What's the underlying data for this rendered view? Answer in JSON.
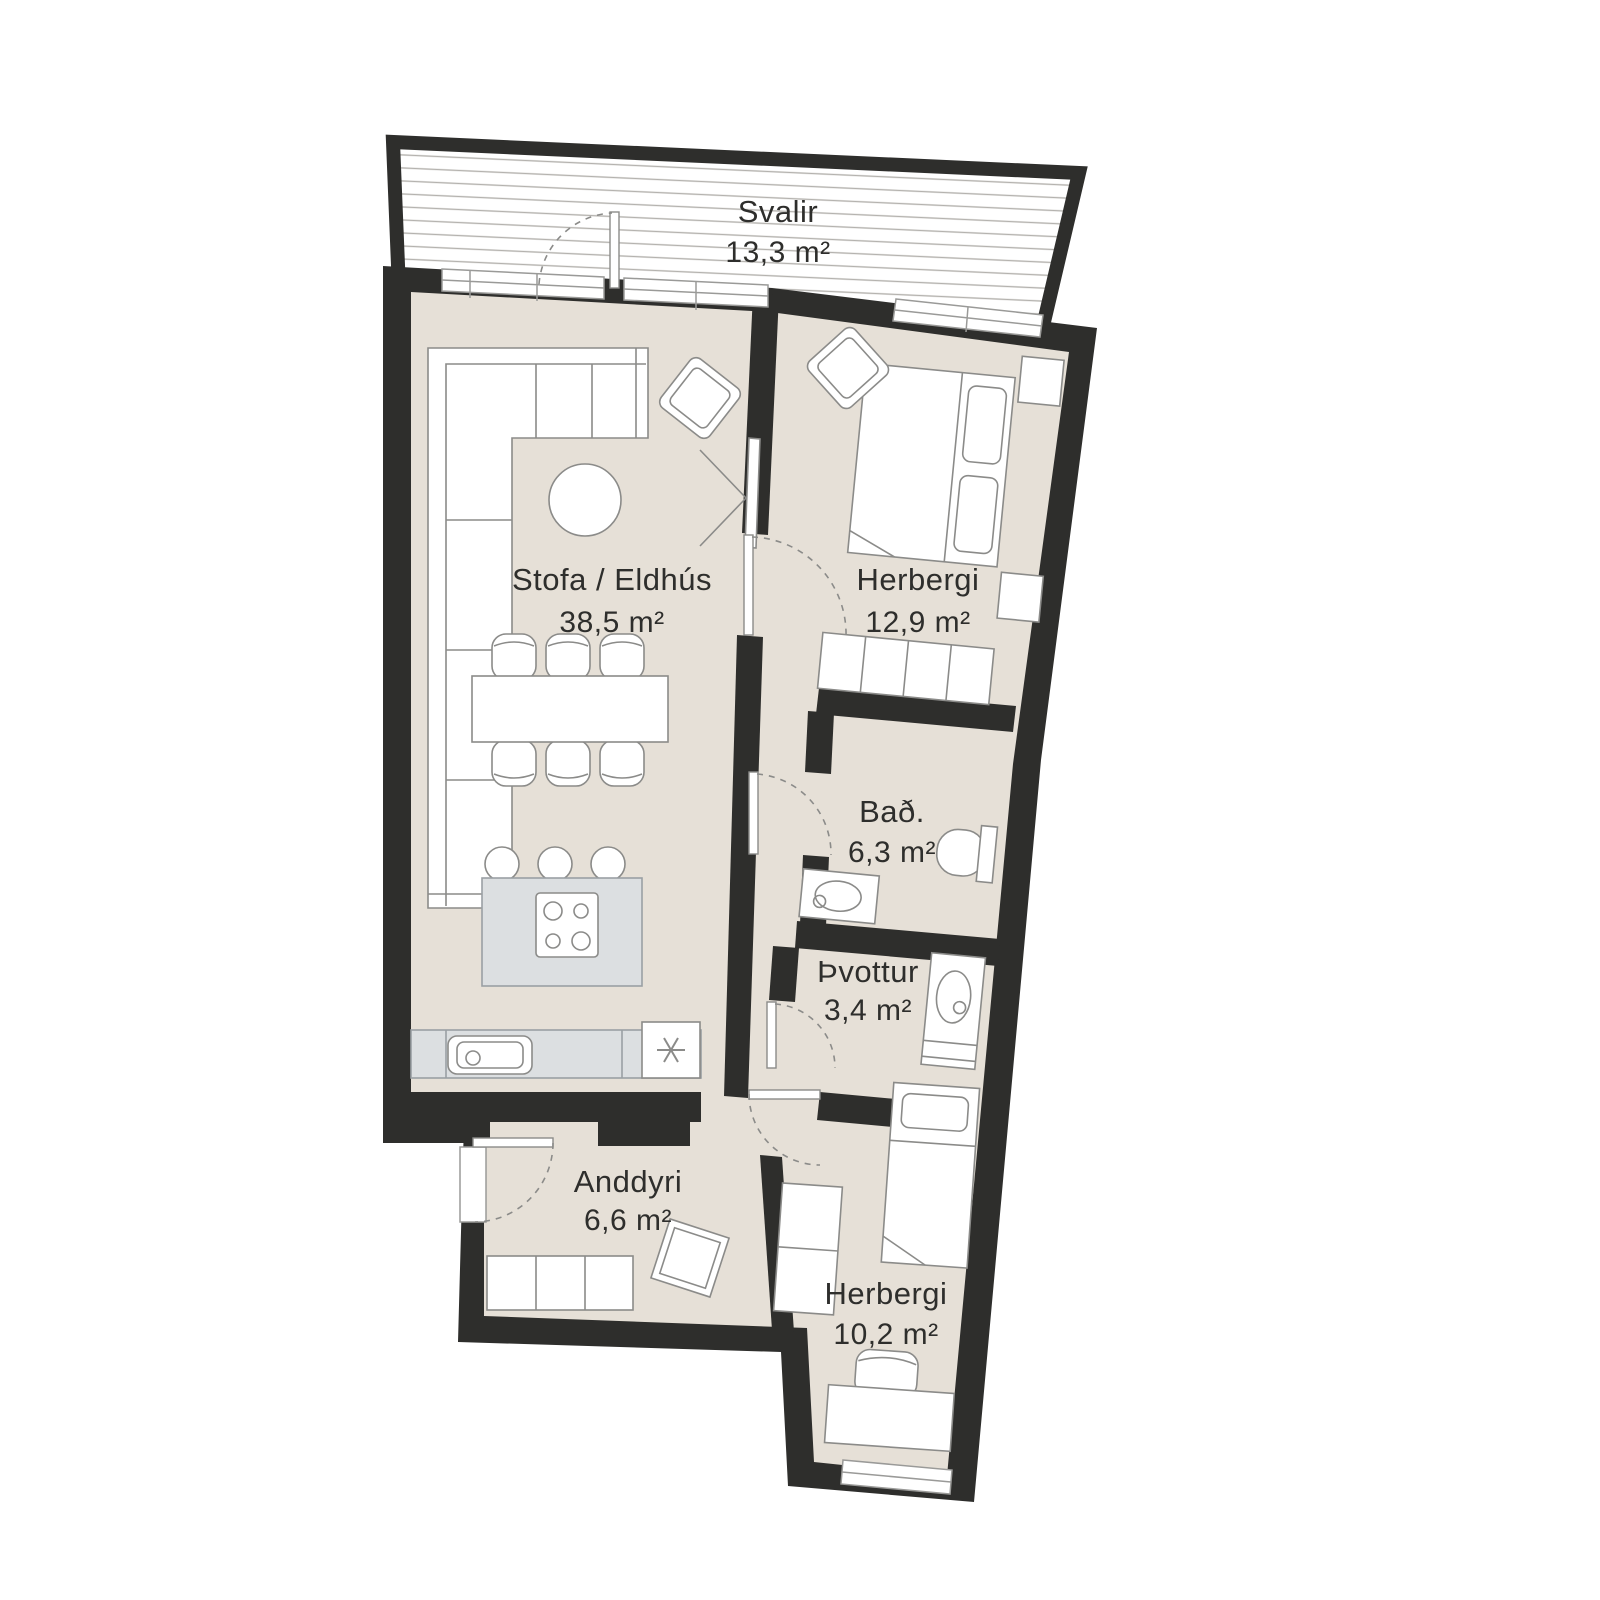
{
  "plan_title": "Apartment floor plan",
  "rooms": [
    {
      "id": "svalir",
      "name": "Svalir",
      "area": "13,3 m²"
    },
    {
      "id": "stofa",
      "name": "Stofa / Eldhús",
      "area": "38,5 m²"
    },
    {
      "id": "herbergi1",
      "name": "Herbergi",
      "area": "12,9 m²"
    },
    {
      "id": "bad",
      "name": "Bað.",
      "area": "6,3 m²"
    },
    {
      "id": "thvottur",
      "name": "Þvottur",
      "area": "3,4 m²"
    },
    {
      "id": "anddyri",
      "name": "Anddyri",
      "area": "6,6 m²"
    },
    {
      "id": "herbergi2",
      "name": "Herbergi",
      "area": "10,2 m²"
    }
  ],
  "furniture": [
    "corner-sofa",
    "coffee-table",
    "armchair",
    "tv",
    "dining-table",
    "dining-chairs",
    "kitchen-island",
    "cooktop",
    "bar-stools",
    "kitchen-counter",
    "sink",
    "fridge",
    "double-bed",
    "nightstands",
    "wardrobe",
    "toilet",
    "vanity-sink",
    "laundry-sink",
    "washer",
    "single-bed",
    "desk",
    "desk-chair",
    "doormat",
    "entry-wardrobe"
  ],
  "colors": {
    "wall": "#2e2e2c",
    "floor": "#e6e0d7",
    "counter_fill": "#dcdfe1",
    "outline": "#8b8b89",
    "deck_line": "#b4b2ae",
    "text": "#2e2e2c"
  }
}
